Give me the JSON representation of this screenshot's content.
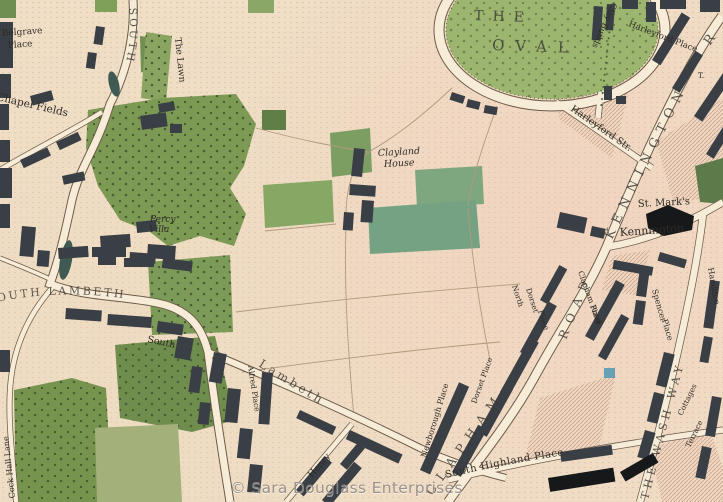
{
  "watermark": "© Sara Douglass Enterprises",
  "colors": {
    "parchment": "#f0dec6",
    "field_green": "#7d9a55",
    "oval_green": "#9cb56f",
    "teal_green": "#74a283",
    "road_fill": "#f7ecd8",
    "road_casing": "#6d5c49",
    "building": "#3a3f45",
    "church_black": "#16181a",
    "hatch_line": "#c89f88",
    "pond": "#3f5a52",
    "water_blue": "#68a0b4",
    "ink": "#2e2b26",
    "watermark_gray": "#8e8a85"
  },
  "labels": {
    "the": "THE",
    "oval": "OVAL",
    "clay_builds": "Clay Builds",
    "harleyford_street": "Harleyford Str.",
    "harleyford_place": "Harleyford Place",
    "kennington_road": "KENNINGTON",
    "kennington_road_r": "R",
    "turnpike": "T.",
    "st_marks": "St. Mark's",
    "kennington": "Kennington",
    "belgrave_place": [
      "Belgrave",
      "Place"
    ],
    "chapel_fields": "Chapel Fields",
    "south_vertical": "SOUTH",
    "the_lawn": "The Lawn",
    "percy_villa": [
      "Percy",
      "Villa"
    ],
    "clayland_house": [
      "Clayland",
      "House"
    ],
    "south_lambeth": "SOUTH LAMBETH",
    "south": "South",
    "lambeth": "Lambeth",
    "alfred_place": "Alfred Place",
    "henry": "Henry",
    "north_dorset_place": [
      "North",
      "Dorset",
      "Place"
    ],
    "road": "ROAD",
    "clapham_road_place": [
      "Clapham Road",
      "Place"
    ],
    "clapham": "CLAPHAM",
    "spencer_place": [
      "Spencer",
      "Place"
    ],
    "hamilton": "Hamilton",
    "the_wash_way": "THE WASH WAY",
    "south_highland_place": "South Highland Place",
    "newborough_place": "Newborough Place",
    "dorset_place": "Dorset Place",
    "cock_hall_lane": "Cock Hall Lane",
    "cottages": "Cottages",
    "terrace": "Terrace"
  }
}
